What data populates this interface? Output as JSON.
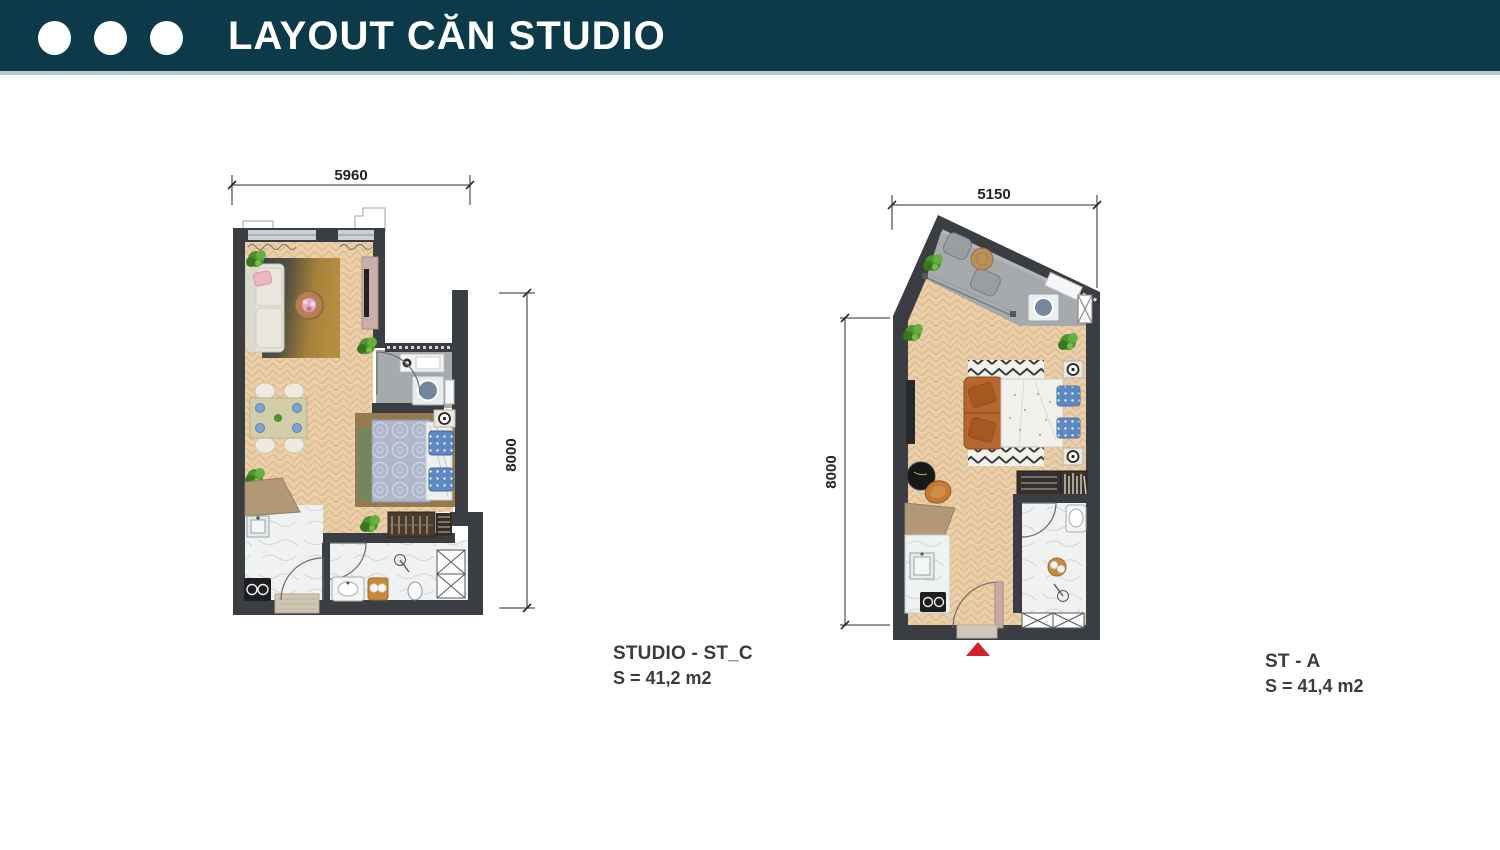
{
  "header": {
    "title": "LAYOUT CĂN STUDIO",
    "dot_count": 3
  },
  "plans": {
    "st_c": {
      "name": "STUDIO - ST_C",
      "area": "S = 41,2 m2",
      "dim_width": "5960",
      "dim_height": "8000"
    },
    "st_a": {
      "name": "ST - A",
      "area": "S = 41,4 m2",
      "dim_width": "5150",
      "dim_height": "8000"
    }
  },
  "colors": {
    "header_bg": "#0d3a49",
    "header_divider": "#b7c7cf",
    "wall": "#3a3e42",
    "wood_floor": "#eacfa8",
    "gray_floor": "#a6aaad",
    "marble_floor": "#f0f2f2",
    "rug_dark": "#3a414b",
    "rug_gold": "#b78c3e",
    "sofa_orange": "#b5672f",
    "entrance_arrow": "#d3222a"
  }
}
